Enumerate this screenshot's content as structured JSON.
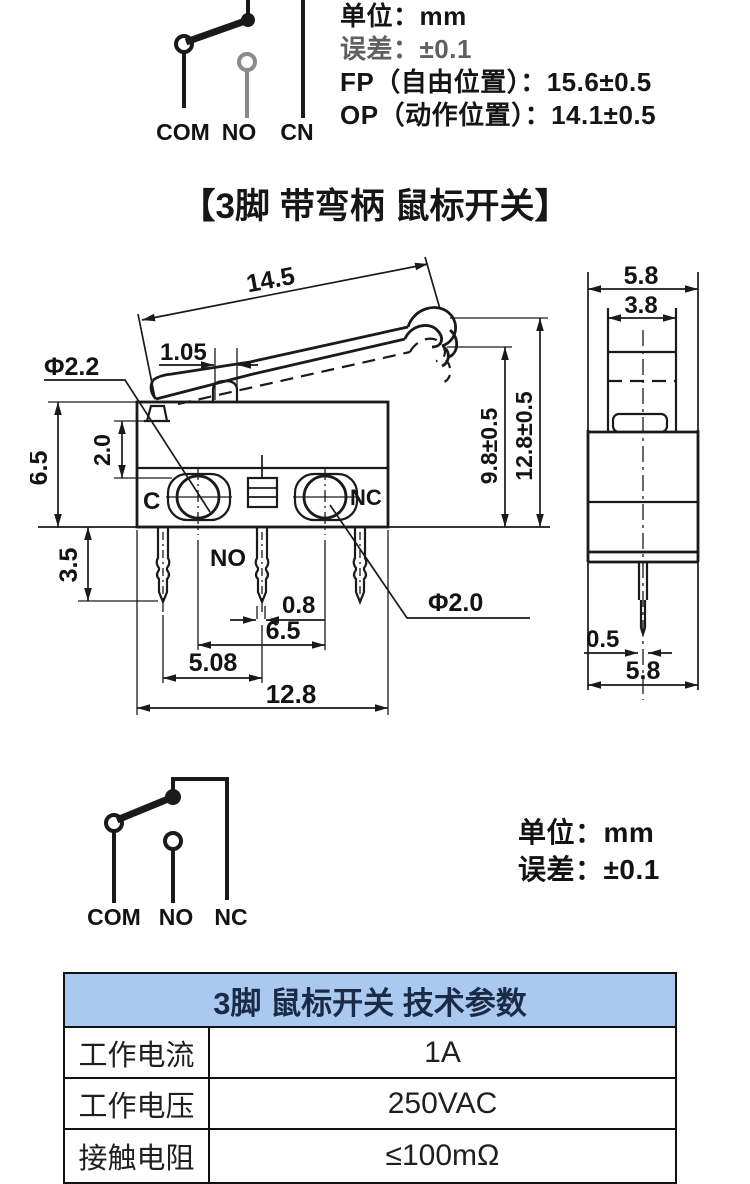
{
  "colors": {
    "ink": "#1a1a1a",
    "schematic_gray": "#8a8a8a",
    "table_header_bg": "#a9c9f0",
    "table_header_text": "#1b2b45"
  },
  "top_section": {
    "schematic_labels": {
      "com": "COM",
      "no": "NO",
      "cn": "CN"
    },
    "notes": {
      "unit": "单位：mm",
      "tolerance": "误差：±0.1",
      "fp": "FP（自由位置）：15.6±0.5",
      "op": "OP（动作位置）：14.1±0.5"
    }
  },
  "title": "【3脚 带弯柄 鼠标开关】",
  "front_view": {
    "dims": {
      "lever_length": "14.5",
      "plunger_width": "1.05",
      "pivot_hole_dia": "Φ2.2",
      "body_height": "6.5",
      "hole_offset": "2.0",
      "pin_length": "3.5",
      "op_height": "9.8±0.5",
      "free_height": "12.8±0.5",
      "pin_width": "0.8",
      "hole_span": "6.5",
      "pin_pitch": "5.08",
      "body_width": "12.8",
      "mount_hole_dia": "Φ2.0"
    },
    "terminals": {
      "c": "C",
      "no": "NO",
      "nc": "NC"
    }
  },
  "side_view": {
    "dims": {
      "top_width": "5.8",
      "lever_width": "3.8",
      "pin_thickness": "0.5",
      "bottom_width": "5.8"
    }
  },
  "bottom_section": {
    "schematic_labels": {
      "com": "COM",
      "no": "NO",
      "nc": "NC"
    },
    "notes": {
      "unit": "单位：mm",
      "tolerance": "误差：±0.1"
    }
  },
  "table": {
    "title": "3脚 鼠标开关 技术参数",
    "rows": [
      {
        "label": "工作电流",
        "value": "1A"
      },
      {
        "label": "工作电压",
        "value": "250VAC"
      },
      {
        "label": "接触电阻",
        "value": "≤100mΩ"
      }
    ]
  }
}
